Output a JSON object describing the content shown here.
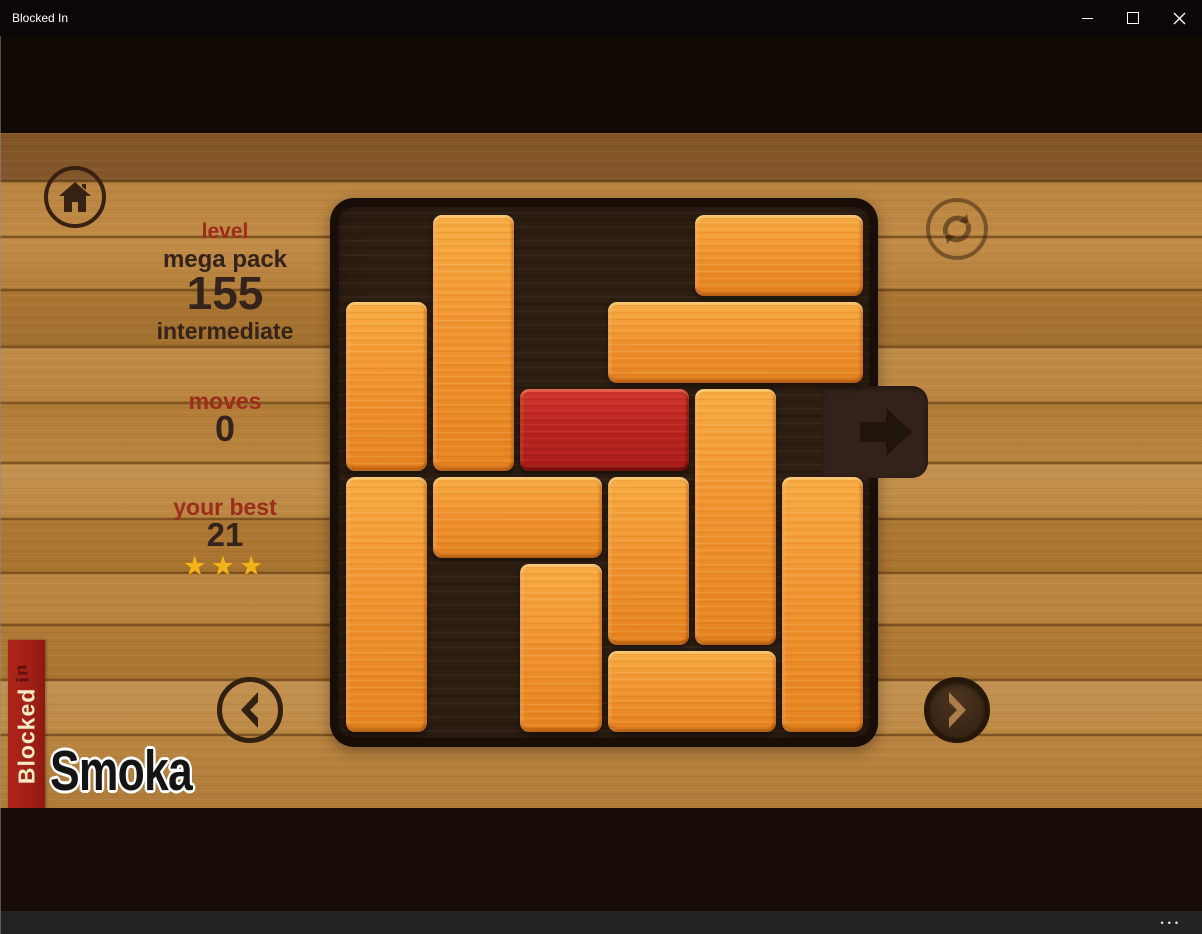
{
  "window": {
    "title": "Blocked In",
    "controls": {
      "minimize": "minimize",
      "maximize": "maximize",
      "close": "close"
    }
  },
  "hud": {
    "level_label": "level",
    "pack_name": "mega pack",
    "level_number": "155",
    "difficulty": "intermediate",
    "moves_label": "moves",
    "moves_value": "0",
    "best_label": "your best",
    "best_value": "21",
    "stars_earned": 3,
    "star_glyph": "★"
  },
  "board": {
    "rows": 6,
    "cols": 6,
    "exit_row": 2,
    "exit_side": "right",
    "blocks": [
      {
        "row": 0,
        "col": 1,
        "len": 3,
        "orient": "v",
        "type": "orange"
      },
      {
        "row": 0,
        "col": 4,
        "len": 2,
        "orient": "h",
        "type": "orange"
      },
      {
        "row": 1,
        "col": 0,
        "len": 2,
        "orient": "v",
        "type": "orange"
      },
      {
        "row": 1,
        "col": 3,
        "len": 3,
        "orient": "h",
        "type": "orange"
      },
      {
        "row": 2,
        "col": 2,
        "len": 2,
        "orient": "h",
        "type": "red"
      },
      {
        "row": 2,
        "col": 4,
        "len": 3,
        "orient": "v",
        "type": "orange"
      },
      {
        "row": 3,
        "col": 0,
        "len": 3,
        "orient": "v",
        "type": "orange"
      },
      {
        "row": 3,
        "col": 1,
        "len": 2,
        "orient": "h",
        "type": "orange"
      },
      {
        "row": 3,
        "col": 3,
        "len": 2,
        "orient": "v",
        "type": "orange"
      },
      {
        "row": 3,
        "col": 5,
        "len": 3,
        "orient": "v",
        "type": "orange"
      },
      {
        "row": 4,
        "col": 2,
        "len": 2,
        "orient": "v",
        "type": "orange"
      },
      {
        "row": 5,
        "col": 3,
        "len": 2,
        "orient": "h",
        "type": "orange"
      }
    ]
  },
  "branding": {
    "banner_word": "Blocked",
    "banner_suffix": "in",
    "watermark": "Smoka"
  },
  "appbar": {
    "more_glyph": "•••"
  },
  "icons": {
    "home": "home-icon",
    "restart": "restart-icon",
    "prev": "chevron-left-icon",
    "next": "chevron-right-icon",
    "exit": "exit-arrow-icon",
    "more": "more-dots-icon",
    "star": "star-icon"
  },
  "colors": {
    "label_red": "#9c2c1b",
    "text_brown": "#33231a",
    "star_gold": "#f2b418",
    "block_orange": "#f09330",
    "block_red": "#bb2520",
    "banner_red": "#a32017",
    "board_bg": "#2d1e12"
  }
}
